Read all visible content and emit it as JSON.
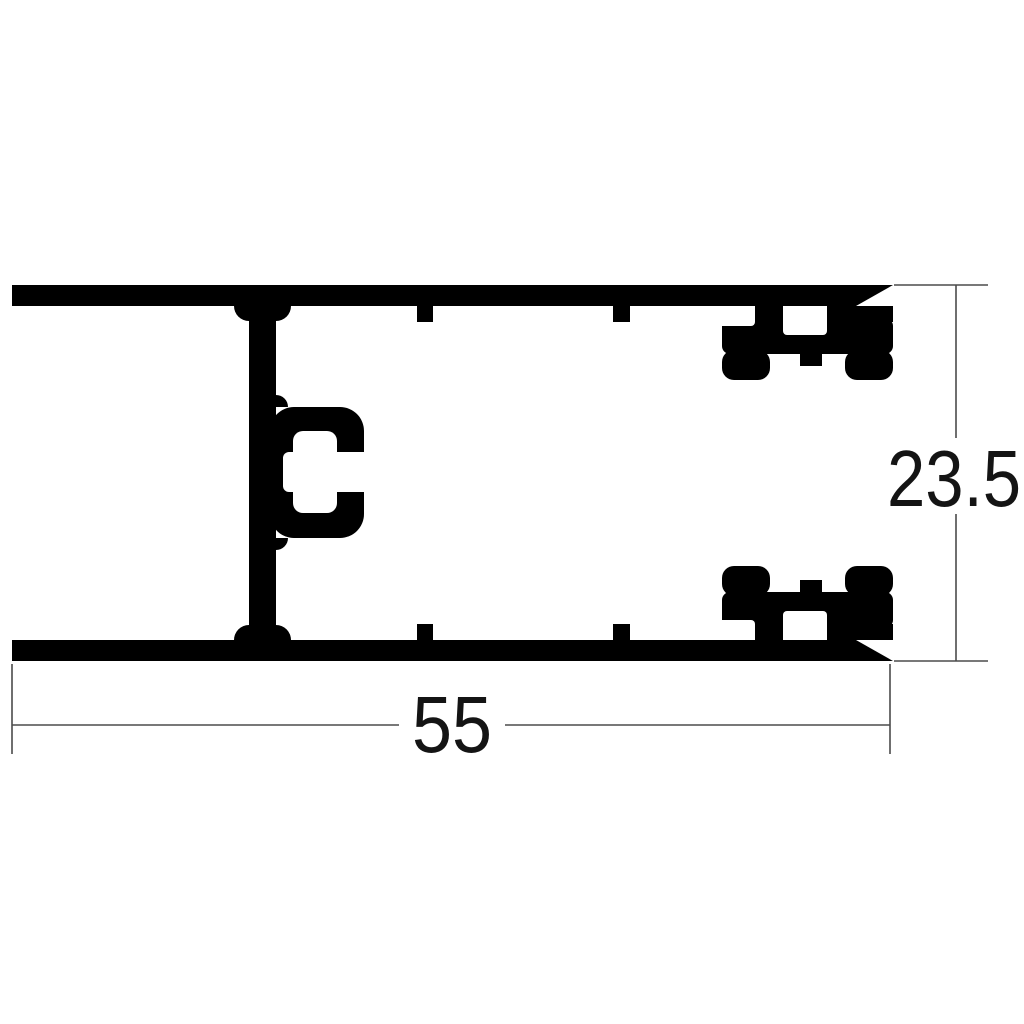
{
  "drawing": {
    "dimensions": {
      "width": {
        "value": "55"
      },
      "height": {
        "value": "23.5"
      }
    },
    "colors": {
      "profile_fill": "#000000",
      "dimension_line": "#4b4b4b",
      "dimension_text": "#141414",
      "background": "#ffffff"
    }
  }
}
